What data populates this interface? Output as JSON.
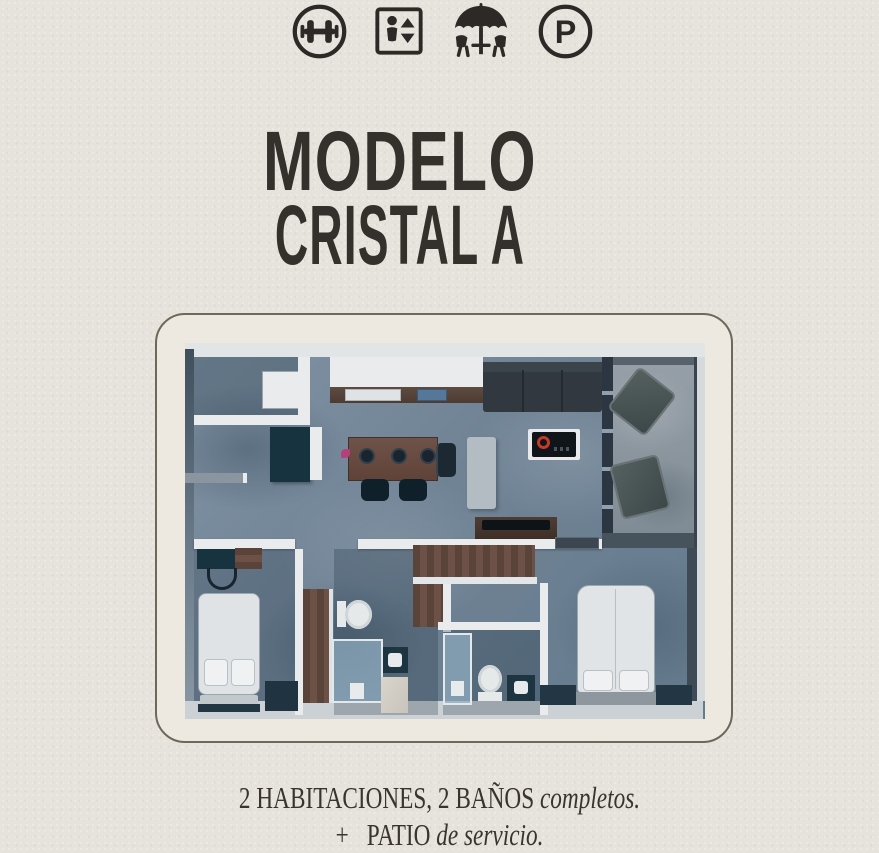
{
  "poster": {
    "amenity_icons": [
      {
        "id": "gym",
        "icon": "dumbbell-icon"
      },
      {
        "id": "elevator",
        "icon": "elevator-icon"
      },
      {
        "id": "terrace",
        "icon": "patio-umbrella-icon"
      },
      {
        "id": "parking",
        "icon": "parking-icon",
        "letter": "P"
      }
    ],
    "title": {
      "line1": "MODELO",
      "line2": "CRISTAL A"
    },
    "features": {
      "line1_regular": "2 HABITACIONES, 2 BAÑOS ",
      "line1_italic": "completos.",
      "line2_prefix": "+",
      "line2_regular": "PATIO ",
      "line2_italic": "de servicio."
    },
    "colors": {
      "ink": "#34302c",
      "paper": "#e6e3dc",
      "card": "#ede9e0",
      "card_border": "#6e675a",
      "floor": "#708395",
      "wall": "#e9ebec",
      "wood": "#6d5146",
      "dark_teal": "#16333f",
      "sofa": "#31383f",
      "shower_glass": "#a5c5db",
      "burner_red": "#c03b2a",
      "flower_pink": "#b6407a"
    },
    "floor_plan": {
      "elements": [
        "washer",
        "pantry-cabinet",
        "kitchen-counter",
        "kitchen-sink",
        "dining-table",
        "dining-chairs",
        "kitchen-cart",
        "cooktop-island",
        "sofa",
        "tv-console",
        "balcony-lounge-chairs",
        "entry-door",
        "bedroom-1-bed",
        "desk",
        "desk-chair",
        "wardrobe",
        "bathroom-1-toilet",
        "bathroom-1-shower",
        "bathroom-1-sink",
        "hall-closet",
        "bathroom-2-shower",
        "bathroom-2-toilet",
        "bathroom-2-sink",
        "bedroom-2-bed",
        "nightstands"
      ]
    }
  }
}
